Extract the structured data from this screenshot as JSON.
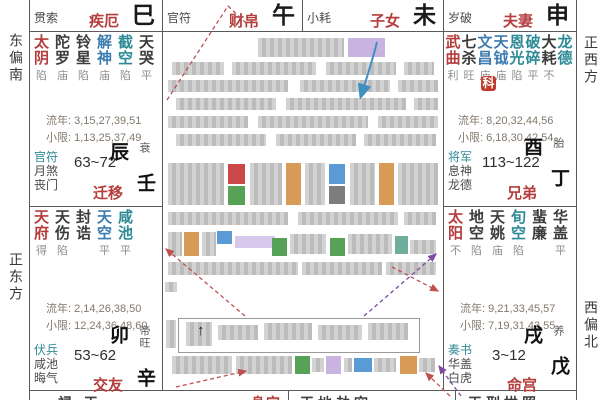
{
  "meta": {
    "title_hint": "紫微斗数命盘 (Zi Wei Dou Shu natal chart, partially redacted)"
  },
  "colors": {
    "accent_red": "#b53d3d",
    "star_black": "#3c3c3c",
    "star_blue": "#3d7cb0",
    "star_teal": "#2d8a96",
    "badge_red": "#c0392b",
    "gray_redact": "#c6c6c6",
    "hl_purple": "#c9b3e0",
    "hl_red": "#cc4848",
    "hl_green": "#57a257",
    "hl_orange": "#d89a57",
    "hl_blue": "#5b9bd5",
    "hl_dkgray": "#7d7d7d",
    "hl_teal": "#6fae9c",
    "hl_lavender": "#d8c9ec",
    "arrow_red": "#c05050",
    "arrow_purple": "#7d4ca0",
    "arrow_blue": "#3f8fc0"
  },
  "compass": {
    "left_top": "东偏南",
    "left_bottom": "正东方",
    "right_top": "正西方",
    "right_bottom": "西偏北"
  },
  "labels": {
    "liunian": "流年:",
    "xiaoxian": "小限:"
  },
  "top_band": [
    {
      "god": "贯索",
      "palace": "疾厄",
      "branch": "巳"
    },
    {
      "god": "官符",
      "palace": "财帛",
      "branch": "午"
    },
    {
      "god": "小耗",
      "palace": "子女",
      "branch": "未"
    },
    {
      "god": "岁破",
      "palace": "夫妻",
      "branch": "申"
    }
  ],
  "palaces": {
    "chen": {
      "stars": [
        [
          "太阴",
          "major",
          "陷"
        ],
        [
          "陀罗",
          "std",
          "庙"
        ],
        [
          "铃星",
          "std",
          "陷"
        ],
        [
          "解神",
          "blue",
          "庙"
        ],
        [
          "截空",
          "teal",
          "陷"
        ],
        [
          "天哭",
          "std",
          "平"
        ]
      ],
      "liunian": "3,15,27,39,51",
      "xiaoxian": "1,13,25,37,49",
      "gods": [
        "官符",
        "月煞",
        "丧门"
      ],
      "age": "63~72",
      "name": "迁移",
      "shengwang": "衰",
      "ganzhi": "壬辰"
    },
    "you": {
      "stars": [
        [
          "武曲",
          "major",
          "利"
        ],
        [
          "七杀",
          "std",
          "旺"
        ],
        [
          "文昌",
          "blue",
          "庙"
        ],
        [
          "天钺",
          "blue",
          "庙"
        ],
        [
          "恩光",
          "teal",
          "陷"
        ],
        [
          "破碎",
          "teal",
          "平"
        ],
        [
          "大耗",
          "std",
          "不"
        ],
        [
          "龙德",
          "teal",
          ""
        ]
      ],
      "badge": {
        "text": "科",
        "note": "on 文昌"
      },
      "liunian": "8,20,32,44,56",
      "xiaoxian": "6,18,30,42,54",
      "gods": [
        "将军",
        "息神",
        "龙德"
      ],
      "age": "113~122",
      "name": "兄弟",
      "shengwang": "胎",
      "ganzhi": "丁酉"
    },
    "mao": {
      "stars": [
        [
          "天府",
          "major",
          "得"
        ],
        [
          "天伤",
          "std",
          "陷"
        ],
        [
          "封诰",
          "std",
          ""
        ],
        [
          "天空",
          "blue",
          "平"
        ],
        [
          "咸池",
          "teal",
          "平"
        ]
      ],
      "liunian": "2,14,26,38,50",
      "xiaoxian": "12,24,36,48,60",
      "gods": [
        "伏兵",
        "咸池",
        "晦气"
      ],
      "age": "53~62",
      "name": "交友",
      "shengwang": "帝旺",
      "ganzhi": "辛卯"
    },
    "xu": {
      "stars": [
        [
          "太阳",
          "major",
          "不"
        ],
        [
          "地空",
          "std",
          "陷"
        ],
        [
          "天姚",
          "std",
          "庙"
        ],
        [
          "旬空",
          "teal",
          "陷"
        ],
        [
          "蜚廉",
          "std",
          ""
        ],
        [
          "华盖",
          "std",
          "平"
        ]
      ],
      "liunian": "9,21,33,45,57",
      "xiaoxian": "7,19,31,43,55",
      "gods": [
        "奏书",
        "华盖",
        "白虎"
      ],
      "age": "3~12",
      "name": "命宫",
      "shengwang": "养",
      "ganzhi": "戊戌"
    }
  },
  "center": {
    "redacted": true,
    "up_glyph": "↑",
    "redacted_blocks": [
      [
        258,
        38,
        86,
        19,
        "g"
      ],
      [
        348,
        38,
        37,
        19,
        "purple"
      ],
      [
        172,
        62,
        52,
        13,
        "g"
      ],
      [
        232,
        62,
        84,
        13,
        "g"
      ],
      [
        326,
        62,
        70,
        13,
        "g"
      ],
      [
        404,
        62,
        30,
        13,
        "g"
      ],
      [
        168,
        80,
        120,
        12,
        "g"
      ],
      [
        300,
        80,
        90,
        12,
        "g"
      ],
      [
        398,
        80,
        40,
        12,
        "g"
      ],
      [
        176,
        98,
        100,
        12,
        "g"
      ],
      [
        286,
        98,
        120,
        12,
        "g"
      ],
      [
        414,
        98,
        24,
        12,
        "g"
      ],
      [
        168,
        116,
        80,
        12,
        "g"
      ],
      [
        258,
        116,
        110,
        12,
        "g"
      ],
      [
        378,
        116,
        60,
        12,
        "g"
      ],
      [
        176,
        134,
        90,
        12,
        "g"
      ],
      [
        276,
        134,
        80,
        12,
        "g"
      ],
      [
        364,
        134,
        72,
        12,
        "g"
      ],
      [
        168,
        163,
        56,
        42,
        "g"
      ],
      [
        228,
        164,
        17,
        20,
        "red"
      ],
      [
        228,
        186,
        17,
        19,
        "green"
      ],
      [
        250,
        163,
        32,
        42,
        "g"
      ],
      [
        286,
        163,
        15,
        42,
        "orange"
      ],
      [
        305,
        163,
        20,
        42,
        "g"
      ],
      [
        329,
        164,
        16,
        20,
        "blue"
      ],
      [
        329,
        186,
        16,
        18,
        "dkgray"
      ],
      [
        350,
        163,
        25,
        42,
        "g"
      ],
      [
        379,
        163,
        15,
        42,
        "orange"
      ],
      [
        398,
        163,
        40,
        42,
        "g"
      ],
      [
        168,
        212,
        120,
        13,
        "g"
      ],
      [
        298,
        212,
        100,
        13,
        "g"
      ],
      [
        404,
        212,
        32,
        13,
        "g"
      ],
      [
        168,
        232,
        14,
        24,
        "g"
      ],
      [
        184,
        232,
        15,
        24,
        "orange"
      ],
      [
        202,
        232,
        14,
        24,
        "g"
      ],
      [
        217,
        231,
        15,
        13,
        "blue"
      ],
      [
        235,
        236,
        40,
        12,
        "lav"
      ],
      [
        272,
        238,
        15,
        18,
        "green"
      ],
      [
        290,
        234,
        36,
        20,
        "g"
      ],
      [
        330,
        238,
        15,
        18,
        "green"
      ],
      [
        348,
        234,
        44,
        20,
        "g"
      ],
      [
        395,
        236,
        13,
        18,
        "teal"
      ],
      [
        410,
        240,
        26,
        14,
        "g"
      ],
      [
        168,
        262,
        130,
        13,
        "g"
      ],
      [
        302,
        262,
        80,
        13,
        "g"
      ],
      [
        386,
        262,
        50,
        13,
        "g"
      ],
      [
        165,
        282,
        12,
        10,
        "g"
      ],
      [
        186,
        322,
        26,
        24,
        "g"
      ],
      [
        218,
        325,
        40,
        15,
        "g"
      ],
      [
        264,
        323,
        48,
        17,
        "g"
      ],
      [
        318,
        325,
        44,
        15,
        "g"
      ],
      [
        368,
        323,
        40,
        17,
        "g"
      ],
      [
        166,
        320,
        10,
        28,
        "g"
      ],
      [
        172,
        356,
        60,
        18,
        "g"
      ],
      [
        236,
        356,
        56,
        18,
        "g"
      ],
      [
        295,
        356,
        15,
        18,
        "green"
      ],
      [
        312,
        358,
        12,
        14,
        "g"
      ],
      [
        326,
        356,
        15,
        18,
        "purple"
      ],
      [
        344,
        358,
        8,
        14,
        "g"
      ],
      [
        354,
        358,
        18,
        14,
        "blue"
      ],
      [
        374,
        358,
        22,
        14,
        "g"
      ],
      [
        400,
        356,
        17,
        18,
        "orange"
      ],
      [
        419,
        358,
        16,
        14,
        "g"
      ]
    ],
    "box": [
      178,
      318,
      240,
      33
    ],
    "arrows": [
      {
        "color": "blue",
        "solid": true,
        "path": "M377,42 C372,62 366,80 361,96",
        "head": true
      },
      {
        "color": "red",
        "path": "M167,100 L228,6 L247,24",
        "head": false
      },
      {
        "color": "red",
        "path": "M245,316 L166,249",
        "head": true
      },
      {
        "color": "red",
        "path": "M392,267 L438,291",
        "head": true
      },
      {
        "color": "red",
        "path": "M176,387 L246,371",
        "head": true
      },
      {
        "color": "red",
        "path": "M450,396 L426,373",
        "head": true
      },
      {
        "color": "purple",
        "path": "M364,316 L436,254",
        "head": true
      },
      {
        "color": "purple",
        "path": "M461,396 L439,366",
        "head": true
      }
    ]
  },
  "bottom_strip": {
    "note": "bottom palace row clipped at image edge; only glyph tops visible",
    "cells": [
      {
        "text": "禄 天",
        "color": "dark",
        "x": 58
      },
      {
        "text": "身宫",
        "color": "red",
        "x": 251
      },
      {
        "text": "天地劫空",
        "color": "dark",
        "x": 300
      },
      {
        "text": "天刑拱照",
        "color": "dark",
        "x": 468
      }
    ]
  }
}
